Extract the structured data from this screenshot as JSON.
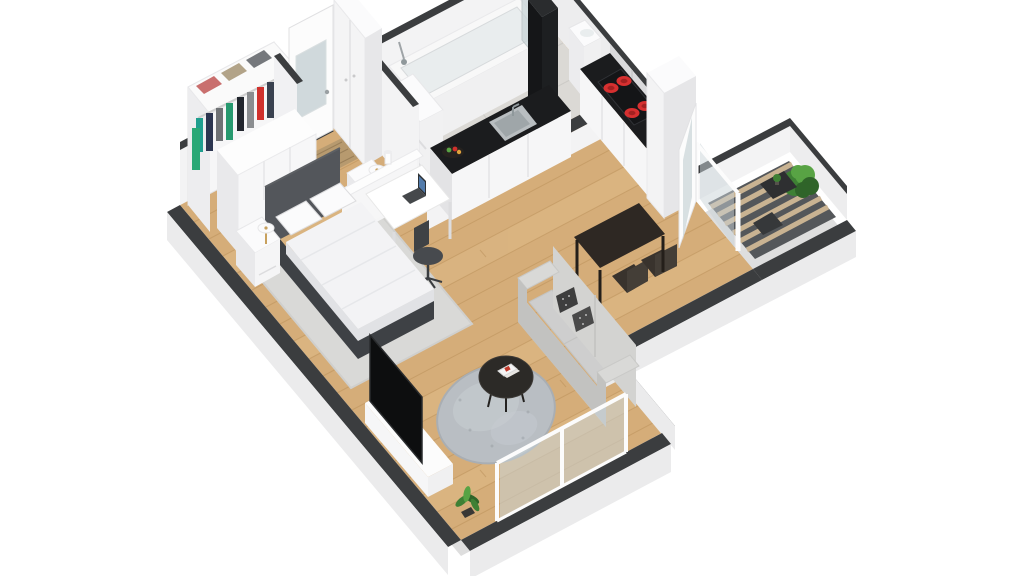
{
  "scene": {
    "title": "3D isometric floor plan render of a one-bedroom apartment with balcony",
    "view": "dollhouse cutaway, viewed from above front-left",
    "background": "#ffffff"
  },
  "objects": [
    "entry-door",
    "doormat",
    "hall-tall-cabinet",
    "open-wardrobe",
    "folded-clothes",
    "hanging-clothes",
    "dresser",
    "double-bed",
    "headboard",
    "bed-pillows",
    "nightstand-left",
    "nightstand-right",
    "table-lamp",
    "bedroom-rug",
    "desk",
    "laptop",
    "office-chair",
    "half-wall",
    "vase",
    "bathtub",
    "shower-mixer",
    "bathroom-shelf",
    "washbasin",
    "glass-screen",
    "kitchen-counter-sink-run",
    "kitchen-sink",
    "fruit-bowl",
    "kitchen-counter-stove-run",
    "induction-hob",
    "range-hood",
    "tall-fridge-cabinet",
    "dining-table",
    "dining-chair",
    "balcony-door-open",
    "balcony-deck",
    "balcony-bush",
    "balcony-table",
    "balcony-bench",
    "sofa",
    "sofa-accent-pillows",
    "round-rug",
    "coffee-table",
    "magazines",
    "tv",
    "tv-media-unit",
    "floor-plant",
    "living-room-window"
  ],
  "colors": {
    "background": "#ffffff",
    "wall_top": "#3b3d3f",
    "wall_face": "#f3f3f4",
    "wall_face_dim": "#ededee",
    "wall_outer": "#ebebec",
    "slab": "#dedede",
    "floor_wood": "#d5ad79",
    "plank_light": "#e0bc8a",
    "plank_seam": "#b98f58",
    "bath_floor": "#dbd9d5",
    "tile_line": "#c9c7c3",
    "deck_dark": "#54575a",
    "deck_light": "#c9b392",
    "counter_top": "#1b1c1e",
    "cabinet_front": "#f6f6f7",
    "cabinet_side": "#e3e3e5",
    "cabinet_tall": "#dadadc",
    "steel": "#b9bec1",
    "steel_dark": "#8f989b",
    "stove_top": "#141517",
    "burner_red": "#d63030",
    "burner_dark": "#a32121",
    "hood_black": "#1d1f21",
    "hood_side": "#151618",
    "tub_white": "#f8f8f8",
    "tub_inner": "#e9edee",
    "bed_frame": "#3e4145",
    "headboard": "#53565b",
    "bedding": "#f3f3f5",
    "bedding_shade": "#e1e2e5",
    "pillow_white": "#fbfbfc",
    "rug_bedroom": "#d9d9d7",
    "rug_round": "#b9bec3",
    "rug_round_light": "#c8cdd2",
    "sofa_body": "#d9d9d7",
    "sofa_cushion": "#cecece",
    "sofa_back": "#d3d3d1",
    "sofa_shade": "#c2c2c0",
    "pillow_pattern": "#3e3e3e",
    "pillow_pattern2": "#4a4a4a",
    "coffee_table": "#2c2a27",
    "dining_table": "#2e2823",
    "dining_chair": "#39332d",
    "desk_top": "#ffffff",
    "office_chair": "#474a4e",
    "door_white": "#fcfcfc",
    "glass": "#c9d4d7",
    "doormat": "#b79a6f",
    "lamp_gold": "#c8a15e",
    "plant_dark": "#2f6429",
    "plant_mid": "#3e8034",
    "plant_light": "#58a344",
    "towel": "#2aa876",
    "pot_dark": "#3a3835",
    "clothes_folded": [
      "#c96f6e",
      "#b2a388",
      "#75787c"
    ],
    "clothes_hanging": [
      "#1f9e8e",
      "#2c3550",
      "#6f7275",
      "#27996f",
      "#22262e",
      "#8a8d90",
      "#d0312d",
      "#39414f"
    ]
  }
}
